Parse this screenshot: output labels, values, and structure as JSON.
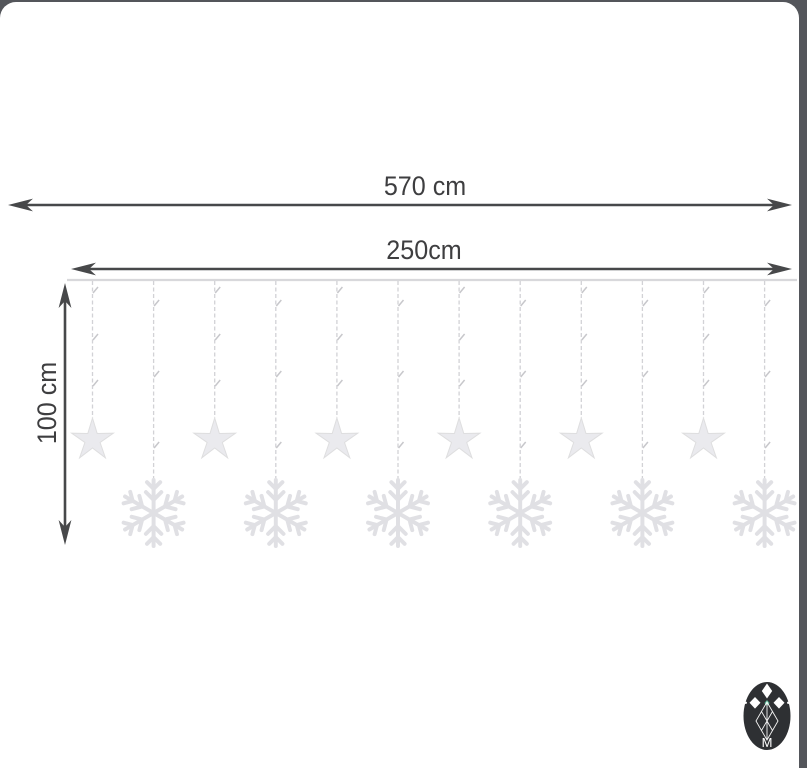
{
  "labels": {
    "overall_width": "570 cm",
    "curtain_width": "250cm",
    "drop_height": "100 cm"
  },
  "logo": {
    "letter": "M"
  },
  "diagram": {
    "type": "product-dimension-diagram",
    "subject": "LED curtain lights with stars and snowflakes",
    "string_count": 12,
    "star_count": 6,
    "snowflake_count": 6,
    "pendants": [
      "star",
      "snowflake",
      "star",
      "snowflake",
      "star",
      "snowflake",
      "star",
      "snowflake",
      "star",
      "snowflake",
      "star",
      "snowflake"
    ]
  },
  "colors": {
    "background": "#54565b",
    "card": "#ffffff",
    "dimension_line": "#47484a",
    "dimension_text": "#3e3e40",
    "rail": "#d8d8db",
    "string": "#d2d2d6",
    "ornament": "#e2e2e6",
    "logo_background": "#2e3033",
    "logo_icon": "#ffffff",
    "logo_accent": "#57b393"
  }
}
